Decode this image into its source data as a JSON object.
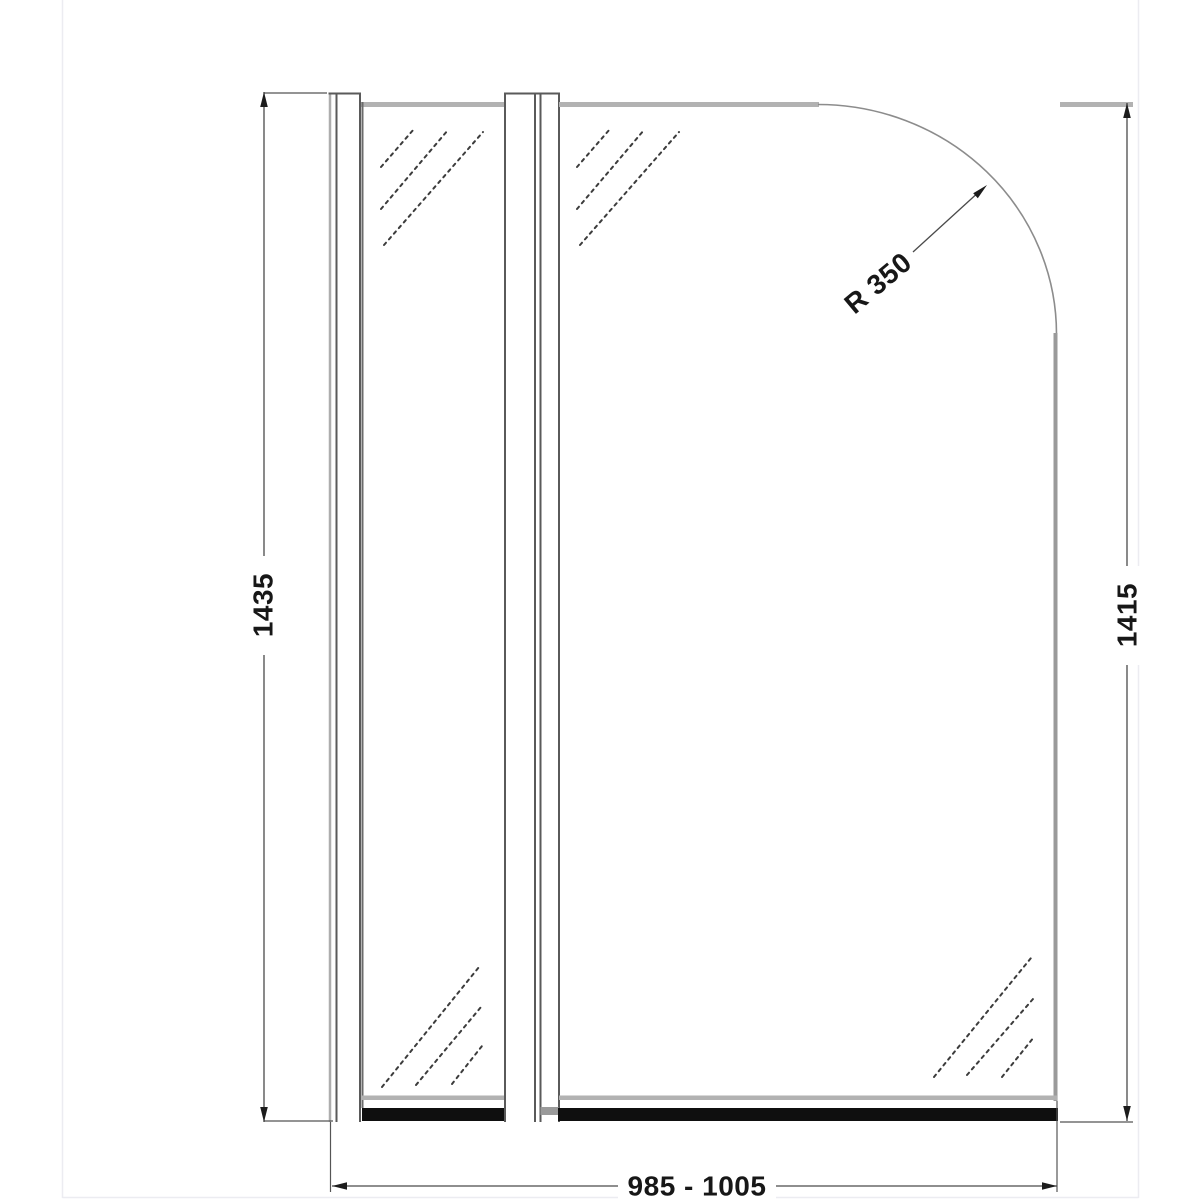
{
  "drawing": {
    "description": "Technical dimension drawing of a hinged bath shower screen with curved top corner, front elevation",
    "labels": {
      "height_left": "1435",
      "height_right": "1415",
      "width_bottom": "985 - 1005",
      "radius": "R 350"
    },
    "colors": {
      "dimension_line": "#4a4a4a",
      "profile_line": "#5a5a5a",
      "glass_edge_gray": "#b2b2b2",
      "right_edge_gray": "#9a9a9a",
      "hinge_channel_gray": "#9a9a9a",
      "bottom_seal_black": "#0f0f0f",
      "text": "#171717",
      "canvas_border": "#ececf1",
      "background": "#ffffff"
    }
  }
}
